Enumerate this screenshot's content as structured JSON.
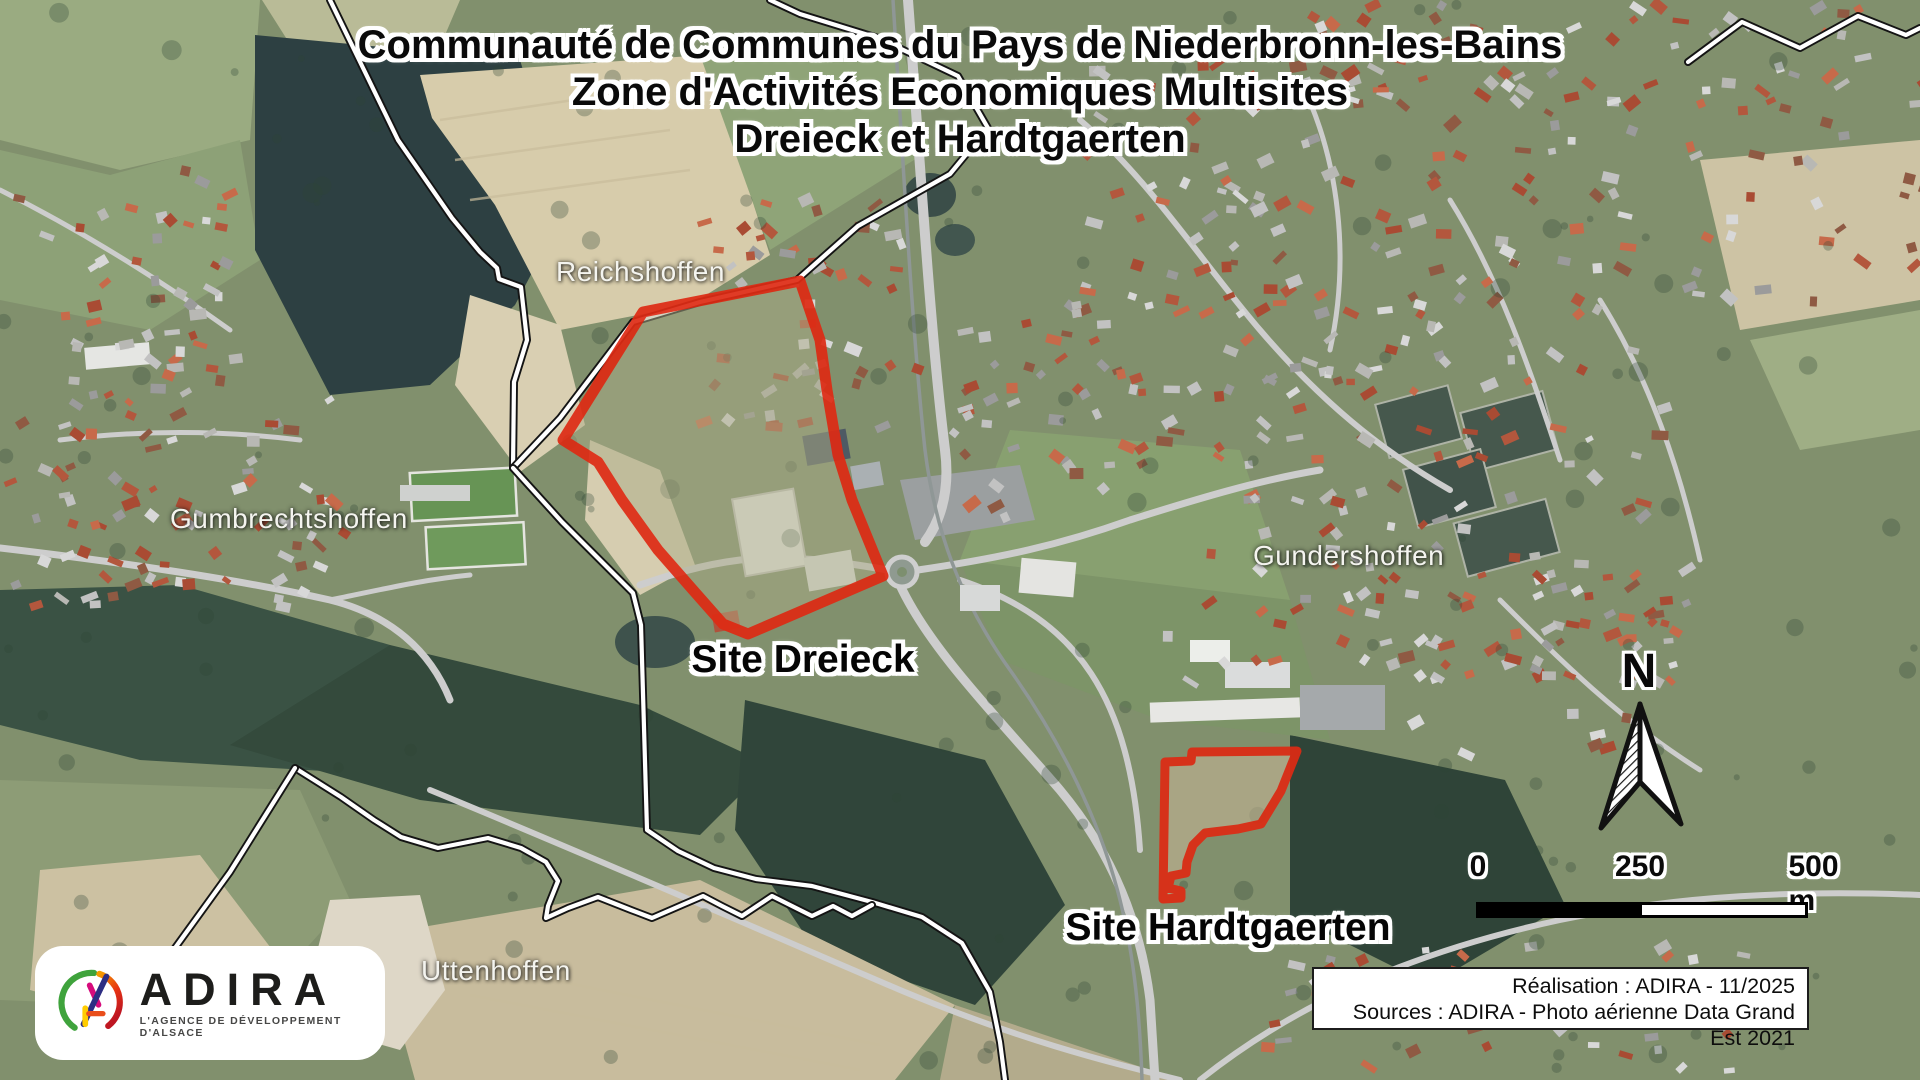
{
  "title": {
    "line1": "Communauté de Communes du Pays de Niederbronn-les-Bains",
    "line2": "Zone d'Activités Economiques Multisites",
    "line3": "Dreieck et Hardtgaerten"
  },
  "labels": {
    "towns": [
      {
        "name": "Reichshoffen"
      },
      {
        "name": "Gumbrechtshoffen"
      },
      {
        "name": "Gundershoffen"
      },
      {
        "name": "Uttenhoffen"
      }
    ],
    "sites": [
      {
        "name": "Site Dreieck"
      },
      {
        "name": "Site Hardtgaerten"
      }
    ]
  },
  "north_arrow": {
    "label": "N"
  },
  "scale_bar": {
    "tick_start": "0",
    "tick_mid": "250",
    "tick_end": "500 m"
  },
  "credits": {
    "line1": "Réalisation : ADIRA - 11/2025",
    "line2": "Sources : ADIRA - Photo aérienne Data Grand Est 2021"
  },
  "logo": {
    "name": "ADIRA",
    "tagline": "L'AGENCE DE DÉVELOPPEMENT D'ALSACE"
  },
  "map_overlay": {
    "colors": {
      "boundary_casing": "#141414",
      "boundary_line": "#ffffff",
      "site_outline": "#de2b14",
      "dreieck_fill": "rgba(171,171,134,0.55)",
      "hardtgaerten_fill": "rgba(196,180,147,0.65)"
    },
    "boundary_lines": [
      [
        [
          330,
          0
        ],
        [
          398,
          140
        ],
        [
          452,
          218
        ],
        [
          480,
          252
        ],
        [
          497,
          268
        ],
        [
          499,
          279
        ],
        [
          521,
          287
        ],
        [
          527,
          340
        ],
        [
          514,
          382
        ],
        [
          513,
          468
        ]
      ],
      [
        [
          513,
          468
        ],
        [
          560,
          418
        ],
        [
          633,
          322
        ],
        [
          700,
          302
        ],
        [
          797,
          280
        ],
        [
          858,
          226
        ],
        [
          950,
          174
        ],
        [
          988,
          128
        ],
        [
          958,
          76
        ],
        [
          878,
          38
        ],
        [
          800,
          14
        ],
        [
          770,
          0
        ]
      ],
      [
        [
          513,
          468
        ],
        [
          562,
          522
        ],
        [
          633,
          593
        ],
        [
          641,
          625
        ],
        [
          647,
          830
        ],
        [
          678,
          851
        ],
        [
          714,
          868
        ],
        [
          756,
          879
        ],
        [
          812,
          886
        ],
        [
          872,
          902
        ],
        [
          922,
          917
        ],
        [
          962,
          943
        ],
        [
          990,
          992
        ],
        [
          1000,
          1042
        ],
        [
          1005,
          1080
        ]
      ],
      [
        [
          295,
          768
        ],
        [
          341,
          797
        ],
        [
          374,
          820
        ],
        [
          401,
          837
        ],
        [
          438,
          848
        ],
        [
          488,
          838
        ],
        [
          521,
          848
        ],
        [
          546,
          862
        ],
        [
          558,
          881
        ],
        [
          548,
          906
        ],
        [
          546,
          918
        ],
        [
          568,
          908
        ],
        [
          598,
          897
        ],
        [
          631,
          910
        ],
        [
          652,
          918
        ],
        [
          682,
          905
        ],
        [
          703,
          896
        ],
        [
          722,
          906
        ],
        [
          742,
          916
        ],
        [
          757,
          906
        ],
        [
          772,
          896
        ],
        [
          792,
          906
        ],
        [
          812,
          916
        ],
        [
          833,
          906
        ],
        [
          852,
          916
        ],
        [
          872,
          905
        ]
      ],
      [
        [
          295,
          768
        ],
        [
          230,
          872
        ],
        [
          175,
          948
        ],
        [
          128,
          1008
        ]
      ],
      [
        [
          1688,
          62
        ],
        [
          1742,
          22
        ],
        [
          1800,
          48
        ],
        [
          1858,
          16
        ],
        [
          1906,
          35
        ],
        [
          1920,
          28
        ]
      ]
    ],
    "site_polygons": {
      "dreieck": [
        [
          800,
          281
        ],
        [
          643,
          312
        ],
        [
          563,
          440
        ],
        [
          598,
          462
        ],
        [
          622,
          500
        ],
        [
          658,
          550
        ],
        [
          693,
          590
        ],
        [
          723,
          624
        ],
        [
          748,
          634
        ],
        [
          883,
          576
        ],
        [
          852,
          500
        ],
        [
          838,
          455
        ],
        [
          827,
          390
        ],
        [
          820,
          340
        ]
      ],
      "hardtgaerten": [
        [
          1165,
          762
        ],
        [
          1191,
          761
        ],
        [
          1192,
          752
        ],
        [
          1297,
          751
        ],
        [
          1281,
          791
        ],
        [
          1261,
          824
        ],
        [
          1238,
          829
        ],
        [
          1205,
          833
        ],
        [
          1193,
          845
        ],
        [
          1187,
          862
        ],
        [
          1186,
          873
        ],
        [
          1171,
          876
        ],
        [
          1168,
          888
        ],
        [
          1181,
          891
        ],
        [
          1181,
          898
        ],
        [
          1163,
          899
        ]
      ]
    }
  }
}
